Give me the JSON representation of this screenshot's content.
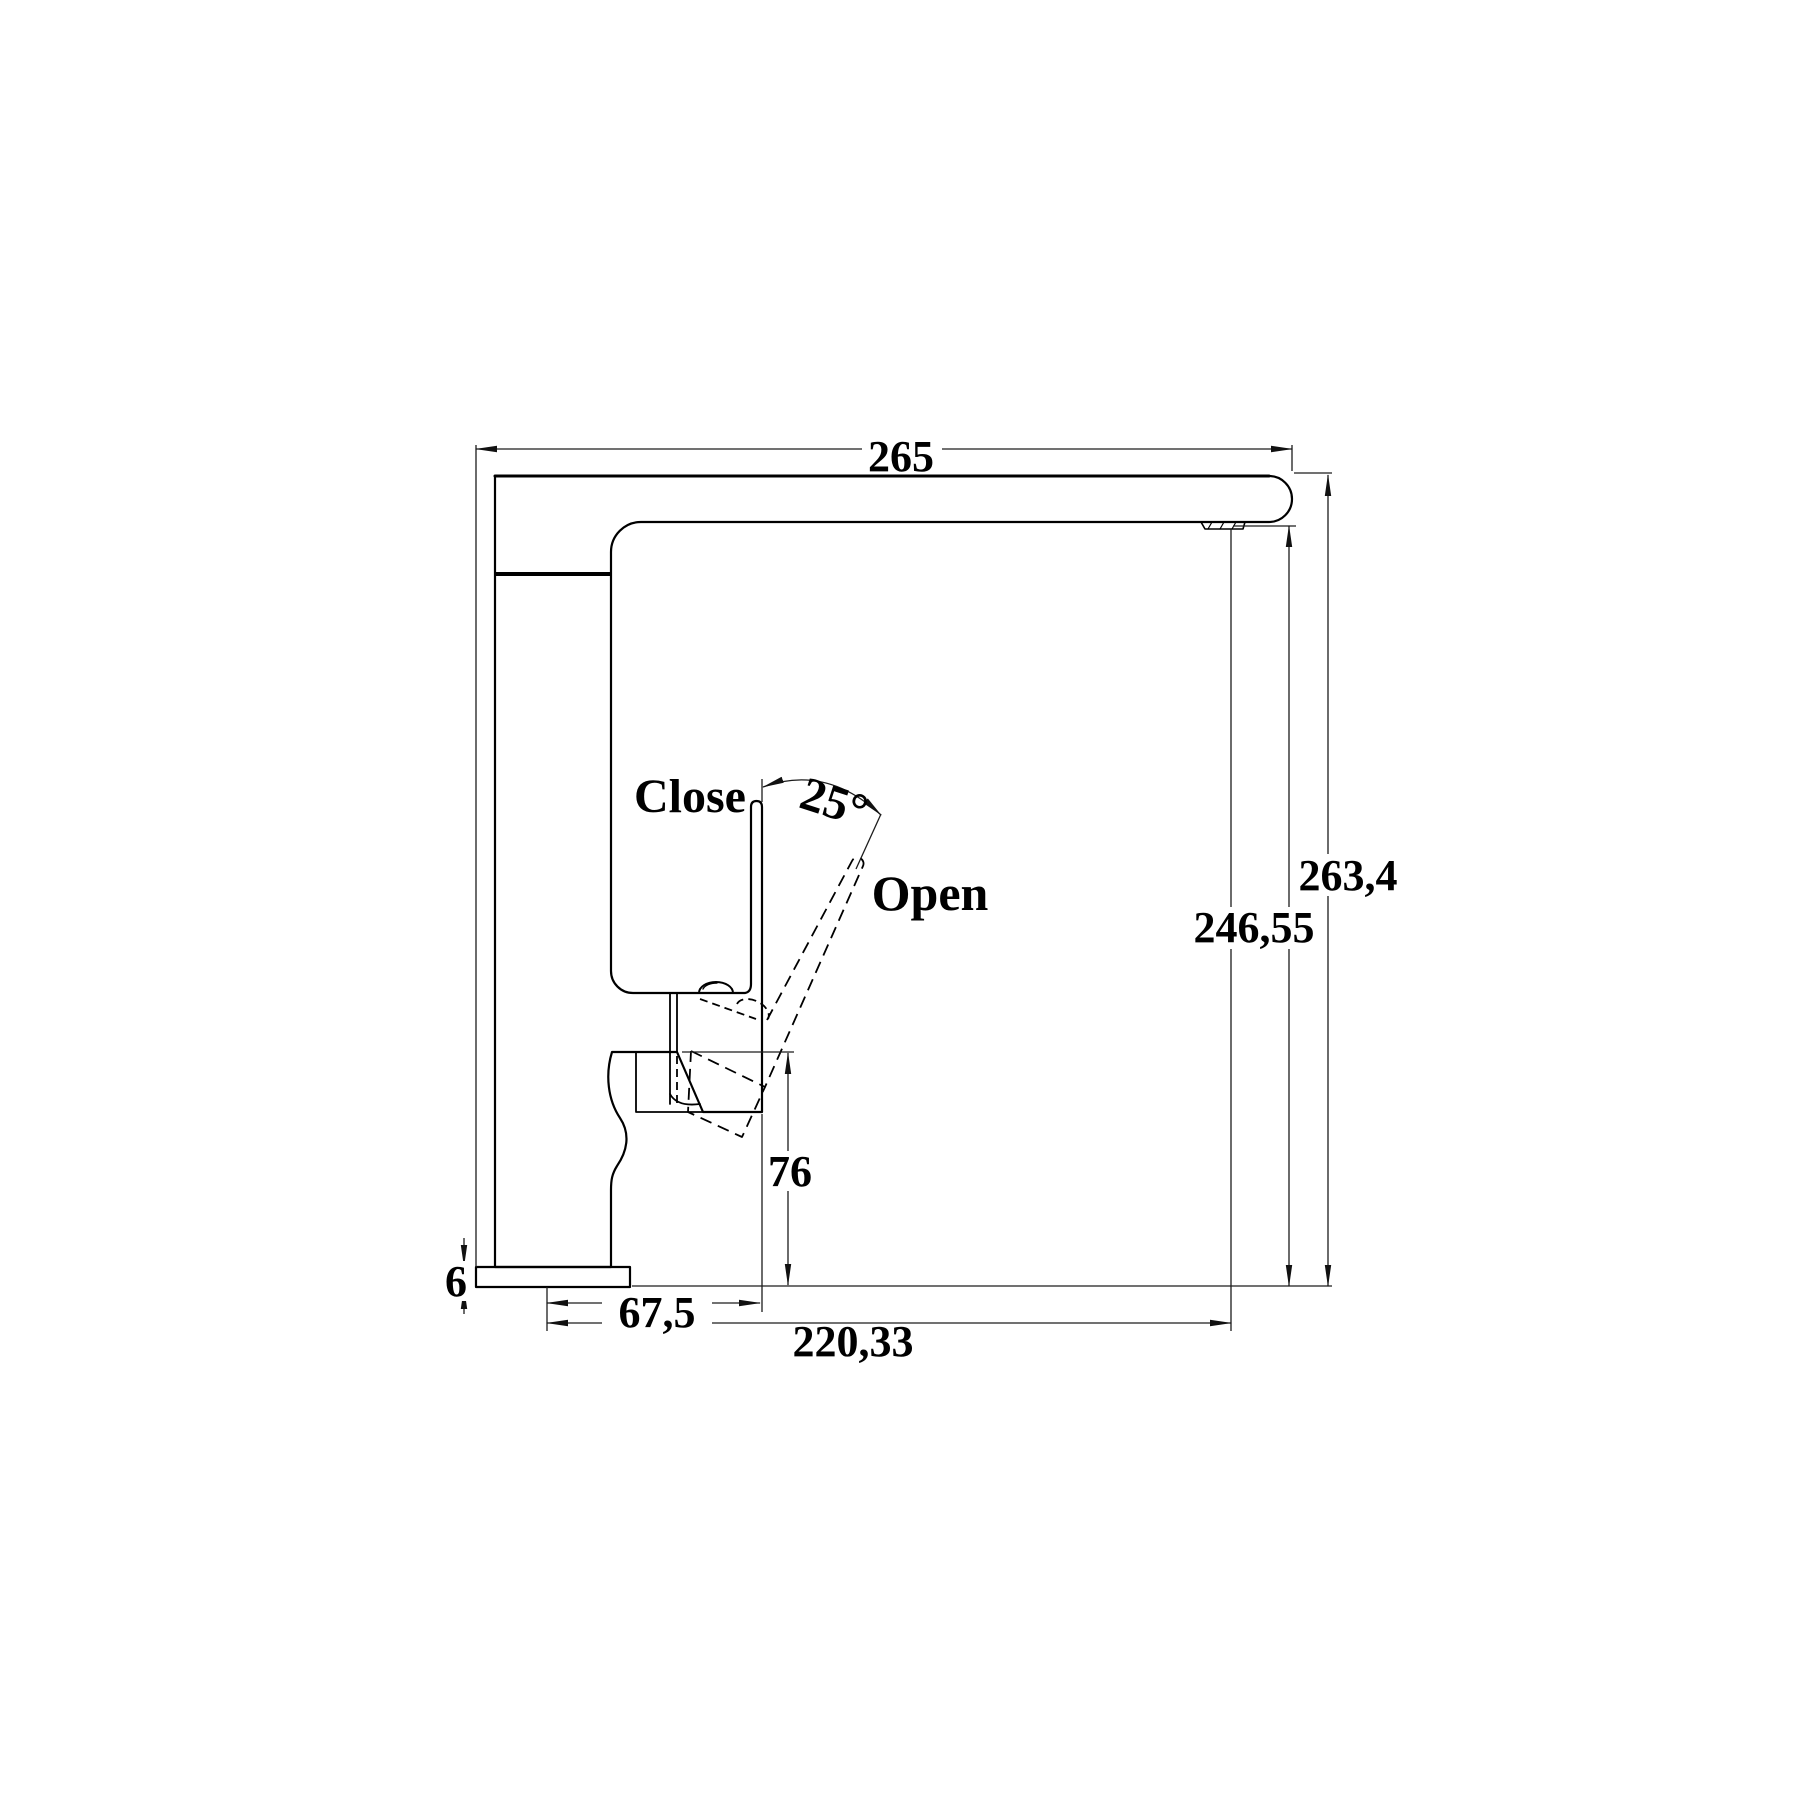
{
  "drawing": {
    "type": "faucet-technical-dimension-drawing",
    "labels": {
      "close": "Close",
      "open": "Open"
    },
    "angle": {
      "handle_open_angle": "25°"
    },
    "dimensions": {
      "top_width": "265",
      "total_height": "263,4",
      "spout_height": "246,55",
      "cartridge_height": "76",
      "base_plate_thickness": "6",
      "handle_offset": "67,5",
      "spout_reach": "220,33"
    },
    "colors": {
      "line": "#000000",
      "dim_line": "#1c1c1c",
      "background": "#ffffff"
    }
  }
}
